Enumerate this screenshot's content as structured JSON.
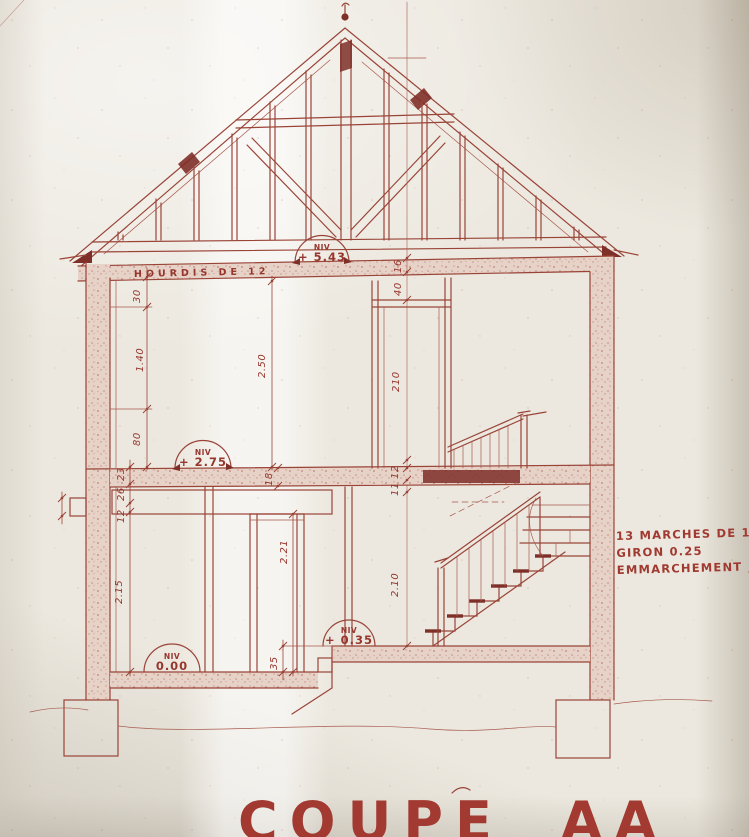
{
  "document": {
    "title": "COUPE AA"
  },
  "labels": {
    "slab_note": "HOURDIS DE 12",
    "level_prefix": "NIV"
  },
  "levels": {
    "ridge": "+ 5.43",
    "first_floor": "+ 2.75",
    "ground": "0.00",
    "half_level": "+ 0.35"
  },
  "stair_note": {
    "line1": "13 MARCHES DE 18⁵",
    "line2": "GIRON 0.25",
    "line3_label": "EMMARCHEMENT",
    "line3_value": "0.80"
  },
  "dimensions": {
    "d30": "30",
    "d140": "1.40",
    "d80": "80",
    "d23": "23",
    "d26": "26",
    "d12": "12",
    "d215": "2.15",
    "d250": "2.50",
    "d16": "16",
    "d40": "40",
    "d210_door": "210",
    "d18": "18",
    "d12b": "12",
    "d11": "11",
    "d221": "2.21",
    "d210_ground": "2.10",
    "d35": "35"
  },
  "colors": {
    "ink": "#9a4438",
    "ink_dark": "#7e2f28",
    "paper": "#ece8df"
  }
}
